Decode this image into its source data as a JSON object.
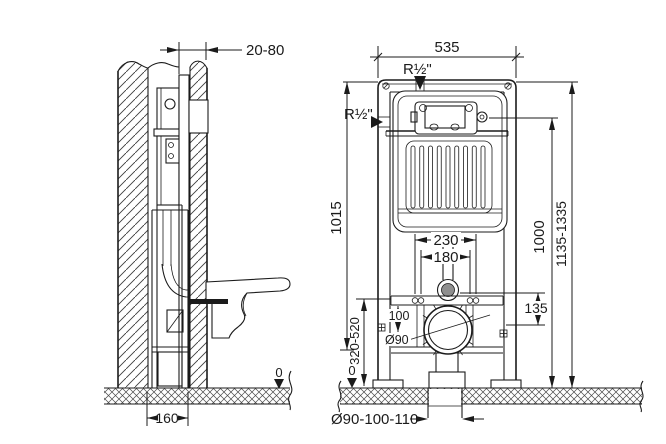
{
  "side_view": {
    "wall_clearance": "20-80",
    "frame_depth": "160",
    "floor_level": "0"
  },
  "front_view": {
    "frame_width": "535",
    "water_supply_top": "R½\"",
    "water_supply_side": "R½\"",
    "height_frame": "1015",
    "height_total": "1135-1335",
    "height_flush_plate": "1000",
    "outlet_height_range": "320-520",
    "fixing_bolts_outer": "230",
    "fixing_bolts_inner": "180",
    "rail_to_outlet": "100",
    "outlet_diameter": "Ø90",
    "supply_to_outlet": "135",
    "drain_pipe_diameters": "Ø90-100-110",
    "floor_level": "0"
  },
  "colors": {
    "line": "#1b1b1b",
    "shaded": "#8f8f8f",
    "background": "#ffffff"
  }
}
